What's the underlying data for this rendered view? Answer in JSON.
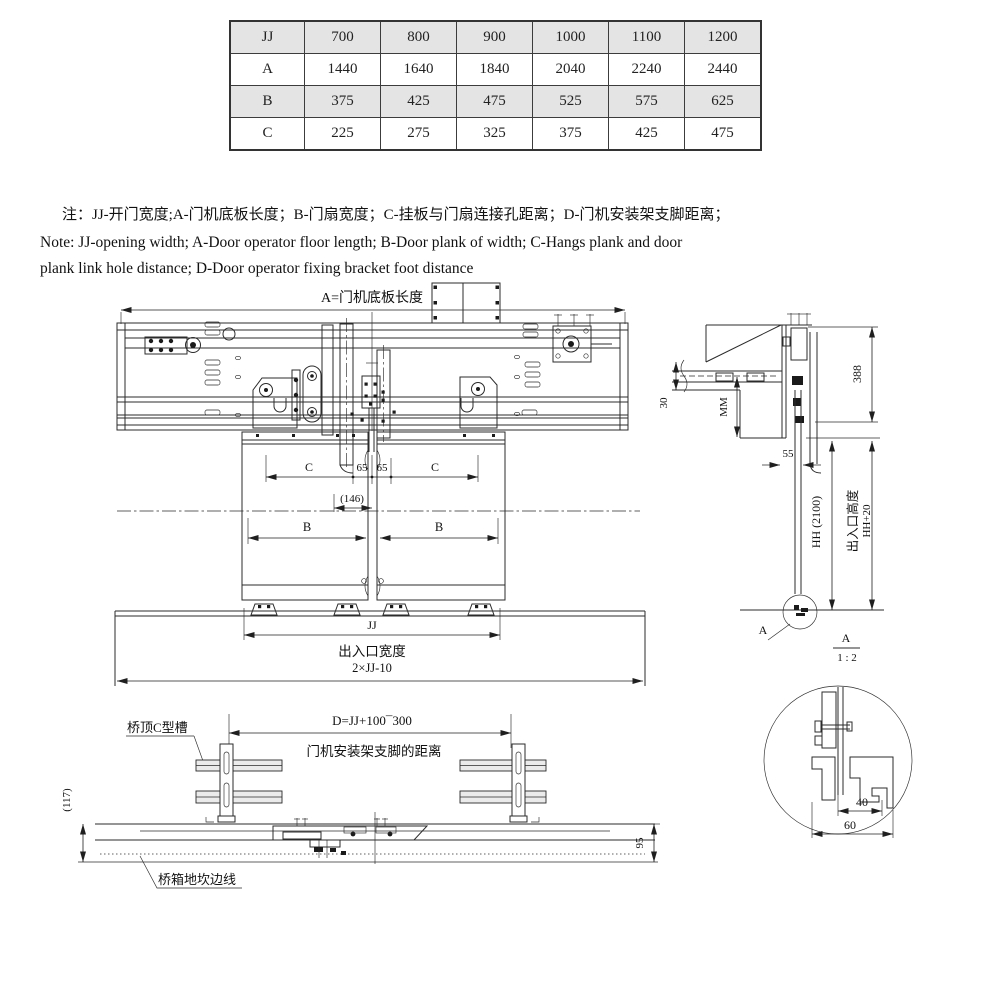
{
  "colors": {
    "table_shade": "#e4e4e4",
    "line_color": "#2b2b2b"
  },
  "table": {
    "rows": [
      {
        "label": "JJ",
        "values": [
          "700",
          "800",
          "900",
          "1000",
          "1100",
          "1200"
        ]
      },
      {
        "label": "A",
        "values": [
          "1440",
          "1640",
          "1840",
          "2040",
          "2240",
          "2440"
        ]
      },
      {
        "label": "B",
        "values": [
          "375",
          "425",
          "475",
          "525",
          "575",
          "625"
        ]
      },
      {
        "label": "C",
        "values": [
          "225",
          "275",
          "325",
          "375",
          "425",
          "475"
        ]
      }
    ]
  },
  "notes": {
    "cn": "注：JJ-开门宽度;A-门机底板长度；B-门扇宽度；C-挂板与门扇连接孔距离；D-门机安装架支脚距离；",
    "en_line1": "Note: JJ-opening width; A-Door operator floor length; B-Door plank of width; C-Hangs plank and door",
    "en_line2": "plank link hole distance; D-Door operator fixing bracket foot distance"
  },
  "front_view": {
    "dim_a_label": "A=门机底板长度",
    "dim_c_left": "C",
    "dim_65_left": "65",
    "dim_65_right": "65",
    "dim_c_right": "C",
    "dim_146": "(146)",
    "dim_b_left": "B",
    "dim_b_right": "B",
    "dim_jj": "JJ",
    "entrance_width_label": "出入口宽度",
    "entrance_width_formula": "2×JJ-10"
  },
  "side_view": {
    "dim_30": "30",
    "dim_mm": "MM",
    "dim_388": "388",
    "dim_55": "55",
    "dim_hh": "HH (2100)",
    "entrance_height_label": "出入口高度",
    "dim_hh20": "HH+20",
    "detail_marker": "A",
    "scale_ref": "A",
    "scale_value": "1 : 2"
  },
  "detail_view": {
    "dim_40": "40",
    "dim_60": "60"
  },
  "bottom_view": {
    "c_channel_label": "桥顶C型槽",
    "dim_d_formula": "D=JJ+100¯300",
    "bracket_distance_label": "门机安装架支脚的距离",
    "dim_117": "(117)",
    "dim_95": "95",
    "sill_edge_label": "桥箱地坎边线"
  }
}
